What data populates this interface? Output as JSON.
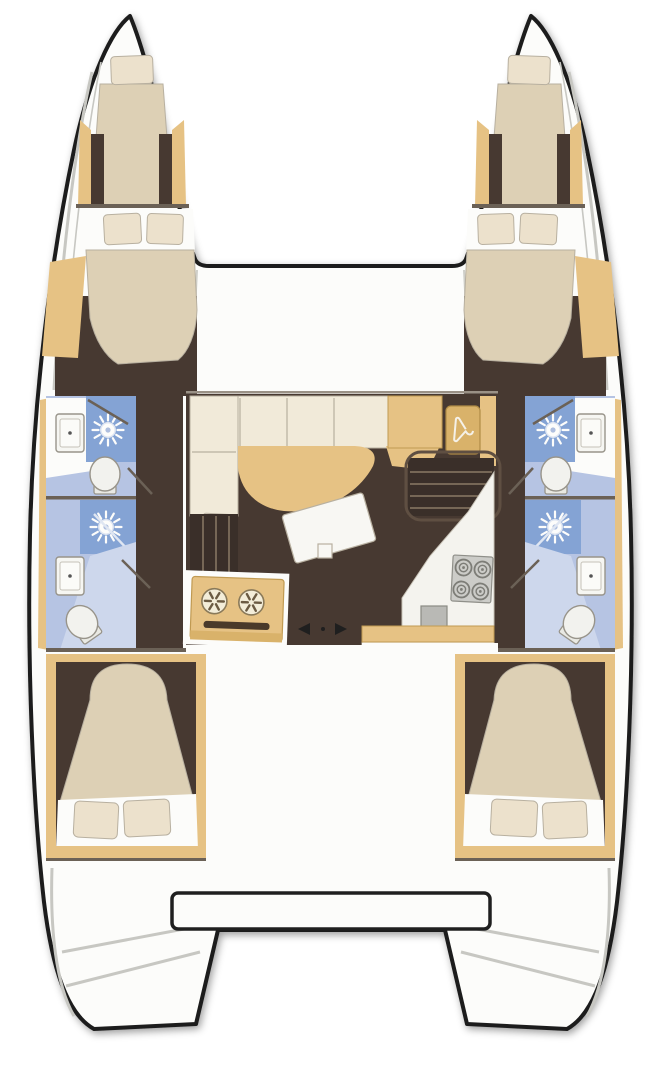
{
  "title": "Catamaran yacht interior layout - overhead floor plan",
  "vessel": {
    "type": "sailing catamaran floor plan, top view",
    "cabins": 4,
    "bathrooms": 4,
    "forepeak_berths": 2,
    "areas": {
      "port_hull": [
        "forepeak berth",
        "forward double cabin",
        "forward bathroom with shower, sink, toilet",
        "aft bathroom with shower, sink, toilet",
        "aft double cabin",
        "transom steps"
      ],
      "starboard_hull": [
        "forepeak berth",
        "forward double cabin",
        "forward bathroom with shower, sink, toilet",
        "aft bathroom with shower, sink, toilet",
        "aft double cabin",
        "transom steps"
      ],
      "saloon": [
        "L-shaped sofa",
        "chaise seat",
        "cocktail table",
        "wardrobe with hanger",
        "port companionway stairs",
        "starboard companionway stairs",
        "two-burner stove oven unit",
        "four-burner hob",
        "galley counter with sink",
        "sliding door arrows"
      ],
      "stern": [
        "aft platform beam",
        "transom steps port",
        "transom steps starboard"
      ]
    }
  },
  "icons": [
    "shower-head-icon",
    "hanger-icon",
    "burner-icon",
    "hob-burner-icon",
    "toilet-icon",
    "sink-icon",
    "door-arrow-left-icon",
    "door-arrow-right-icon"
  ],
  "colors": {
    "hull-outline": "#1f1f1f",
    "deck-white": "#fcfcfa",
    "line-gray": "#b8b0a0",
    "wall-line": "#6b6156",
    "trim-tan": "#e6c284",
    "cabinet-tan": "#d9b26a",
    "tan-stroke": "#c09a52",
    "floor-brown": "#473931",
    "floor-dark": "#392e27",
    "mattress-beige": "#ddd0b5",
    "pillow-cream": "#ece1cc",
    "sofa-cream": "#f1ead9",
    "bath-blue-light": "#b6c4e3",
    "bath-blue-pale": "#cdd7ec",
    "shower-blue": "#84a3d4",
    "fixture-white": "#f4f4f0",
    "fixture-stroke": "#98948a",
    "table-white": "#f8f7f3",
    "stove-gray": "#ccccc8",
    "stove-stroke": "#8f8f89",
    "step-gray": "#c7c7c2",
    "stair-light": "#8a7a66",
    "stair-dark": "#3a2f29"
  }
}
